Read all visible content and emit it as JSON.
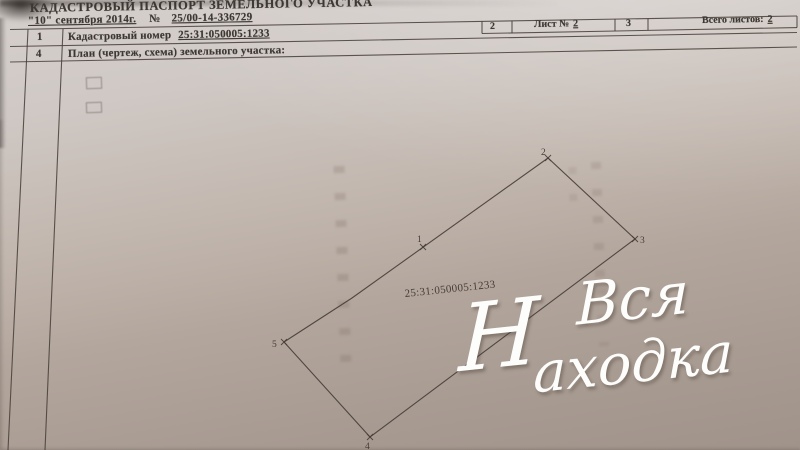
{
  "document": {
    "title": "КАДАСТРОВЫЙ ПАСПОРТ ЗЕМЕЛЬНОГО УЧАСТКА",
    "date_line": "\"10\" сентября 2014г.",
    "number_sign": "№",
    "document_number": "25/00-14-336729",
    "header_cells": {
      "col1": "2",
      "sheet_label": "Лист №",
      "sheet_value": "2",
      "col3": "3",
      "total_label": "Всего листов:",
      "total_value": "2"
    },
    "rows": [
      {
        "num": "1",
        "label": "Кадастровый номер ",
        "value": "25:31:050005:1233"
      },
      {
        "num": "4",
        "label": "План (чертеж, схема) земельного участка:"
      }
    ]
  },
  "plan": {
    "parcel_label": "25:31:050005:1233",
    "label_pos": {
      "x": 405,
      "y": 297,
      "rotate": -6
    },
    "outline": [
      [
        284,
        342
      ],
      [
        352,
        298
      ],
      [
        548,
        158
      ],
      [
        635,
        239
      ],
      [
        370,
        437
      ]
    ],
    "vertices": [
      {
        "n": "1",
        "x": 423,
        "y": 247,
        "lx": 417,
        "ly": 242
      },
      {
        "n": "2",
        "x": 548,
        "y": 158,
        "lx": 541,
        "ly": 155
      },
      {
        "n": "3",
        "x": 635,
        "y": 239,
        "lx": 640,
        "ly": 243
      },
      {
        "n": "4",
        "x": 370,
        "y": 437,
        "lx": 365,
        "ly": 449
      },
      {
        "n": "5",
        "x": 284,
        "y": 342,
        "lx": 272,
        "ly": 347
      }
    ]
  },
  "watermark": {
    "initial": "Н",
    "line1": "Вся",
    "line2": "аходка"
  },
  "colors": {
    "ink": "#3e3833",
    "line": "#463d37",
    "wm": "#fdfdfc",
    "paper_light": "#d2ccc8",
    "paper_dark": "#a0938a"
  }
}
